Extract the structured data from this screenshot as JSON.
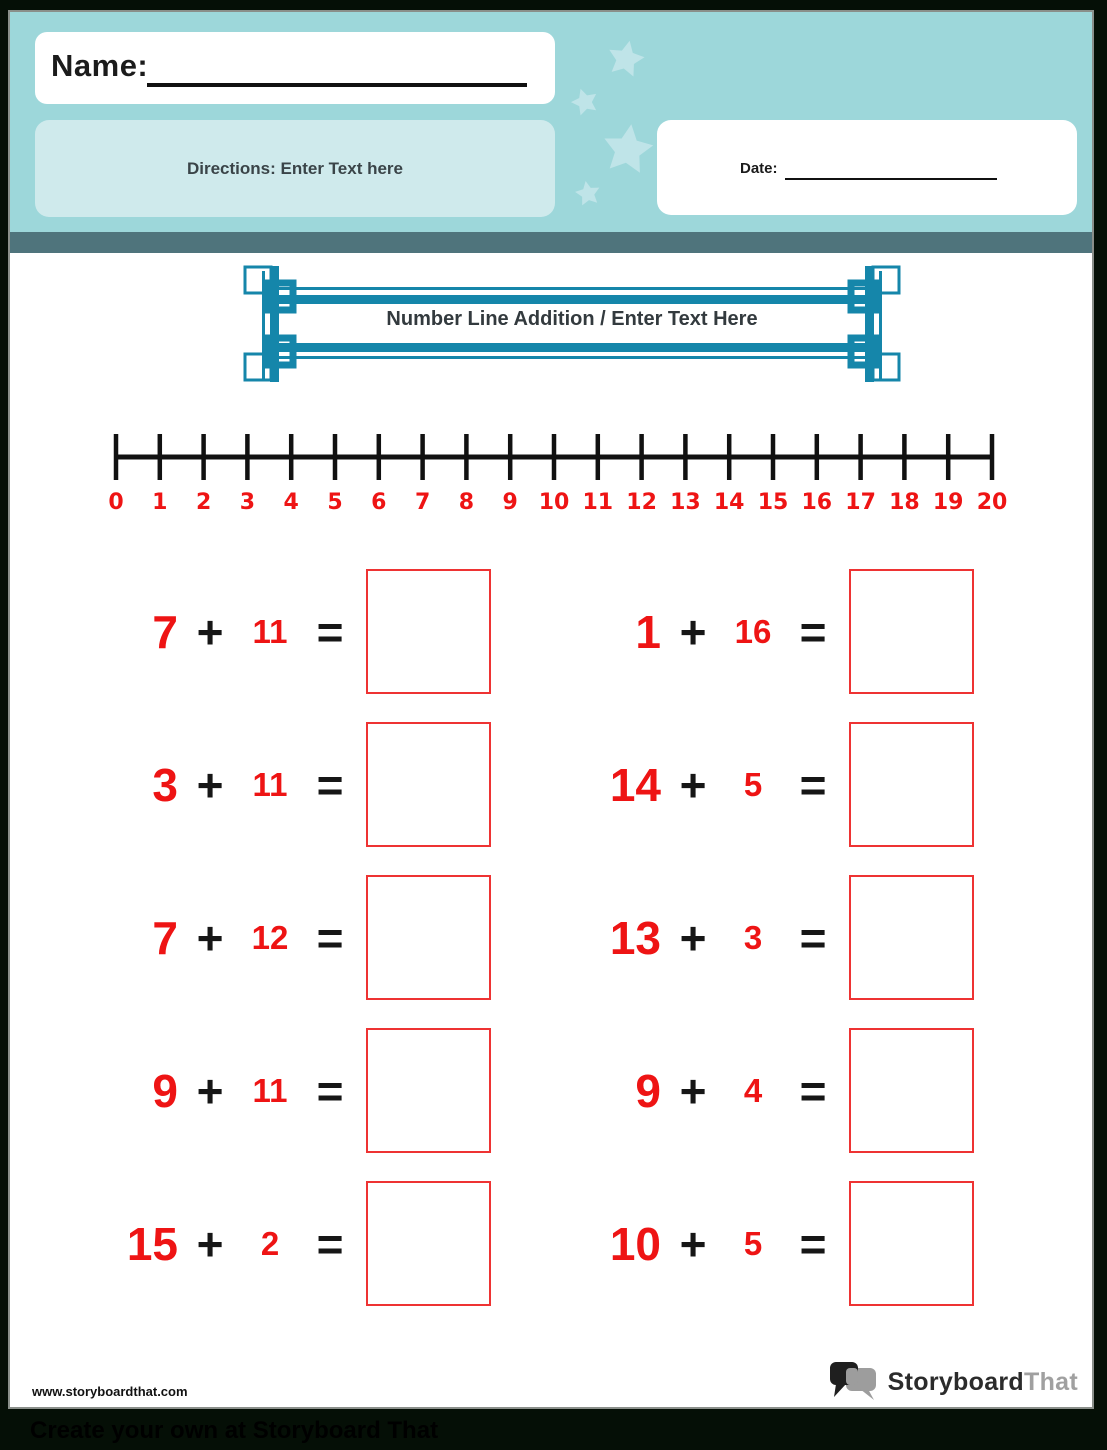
{
  "header": {
    "name_label": "Name:",
    "directions_text": "Directions: Enter Text here",
    "date_label": "Date:"
  },
  "title_banner": {
    "title": "Number Line Addition / Enter Text Here"
  },
  "number_line": {
    "min": 0,
    "max": 20,
    "labels": [
      "0",
      "1",
      "2",
      "3",
      "4",
      "5",
      "6",
      "7",
      "8",
      "9",
      "10",
      "11",
      "12",
      "13",
      "14",
      "15",
      "16",
      "17",
      "18",
      "19",
      "20"
    ]
  },
  "problems": {
    "plus_symbol": "+",
    "equals_symbol": "=",
    "columns": [
      {
        "items": [
          {
            "a": "7",
            "b": "11"
          },
          {
            "a": "3",
            "b": "11"
          },
          {
            "a": "7",
            "b": "12"
          },
          {
            "a": "9",
            "b": "11"
          },
          {
            "a": "15",
            "b": "2"
          }
        ]
      },
      {
        "items": [
          {
            "a": "1",
            "b": "16"
          },
          {
            "a": "14",
            "b": "5"
          },
          {
            "a": "13",
            "b": "3"
          },
          {
            "a": "9",
            "b": "4"
          },
          {
            "a": "10",
            "b": "5"
          }
        ]
      }
    ]
  },
  "footer": {
    "website": "www.storyboardthat.com",
    "logo_text_primary": "Storyboard",
    "logo_text_secondary": "That",
    "banner_text": "Create your own at Storyboard That"
  },
  "colors": {
    "header_teal": "#9dd7da",
    "directions_panel_teal": "#cfeaec",
    "divider_slate": "#4f747c",
    "frame_teal": "#1586aa",
    "number_red": "#ee1414",
    "answer_box_border_red": "#ee3333",
    "star_teal": "#bfe4e8",
    "logo_gray": "#a0a0a0",
    "outer_background": "#050f06"
  }
}
